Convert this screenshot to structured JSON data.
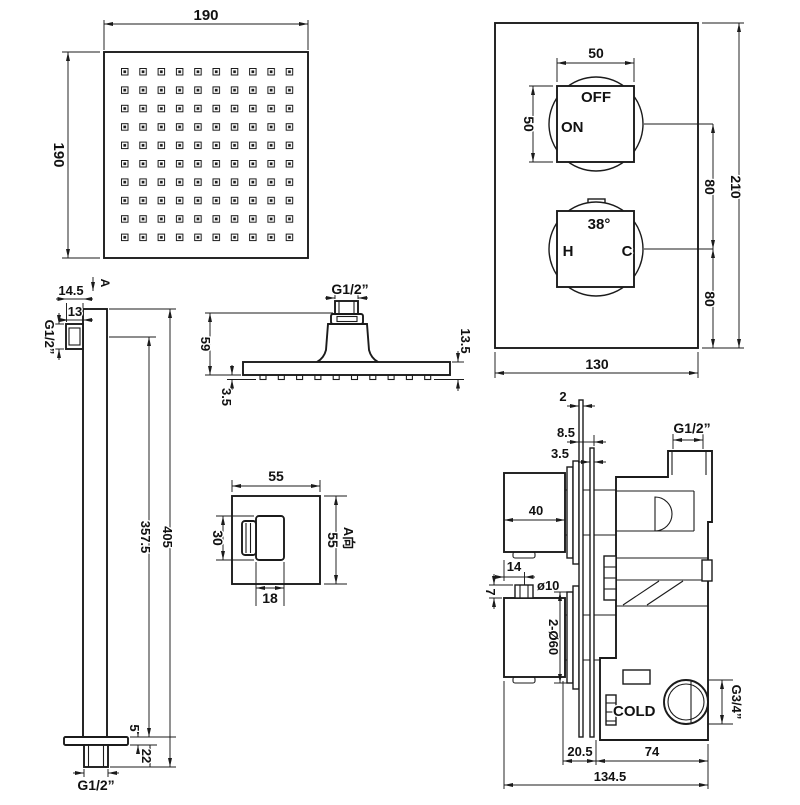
{
  "colors": {
    "background": "#ffffff",
    "line": "#1b1b1b"
  },
  "views": {
    "head_face": {
      "dim_width": "190",
      "dim_height": "190"
    },
    "valve_face": {
      "dim_knob_width": "50",
      "dim_knob_height": "50",
      "label_off": "OFF",
      "label_on": "ON",
      "label_temp": "38°",
      "label_hot": "H",
      "label_cold": "C",
      "dim_knob_gap": "80",
      "dim_knob_bottom": "80",
      "dim_height": "210",
      "dim_width": "130"
    },
    "arm": {
      "dim_top_offset": "14.5",
      "view_marker": "A",
      "dim_outlet_width": "13",
      "label_thread_side": "G1/2”",
      "dim_to_outlet": "357.5",
      "dim_total_length": "405",
      "dim_flange_thickness": "5",
      "dim_stub_length": "22",
      "label_thread_end": "G1/2”"
    },
    "head_side": {
      "label_thread": "G1/2”",
      "dim_height": "59",
      "dim_plate_thickness": "13.5",
      "dim_nozzle_height": "3.5"
    },
    "view_a": {
      "dim_width": "55",
      "dim_height": "55",
      "view_label": "A向",
      "dim_inner_height": "30",
      "dim_inner_width": "18"
    },
    "valve_section": {
      "dim_plate_gap": "2",
      "dim_depth_a": "8.5",
      "dim_depth_b": "3.5",
      "dim_knob_width": "40",
      "dim_screw_offset": "14",
      "dim_screw_dia": "ø10",
      "dim_screw_height": "7",
      "dim_escutcheon": "2-Ø60",
      "label_thread_outlet": "G1/2”",
      "label_cold_inlet": "COLD",
      "label_thread_inlet": "G3/4”",
      "dim_wall_to_body": "20.5",
      "dim_body_depth": "74",
      "dim_total_depth": "134.5"
    }
  }
}
